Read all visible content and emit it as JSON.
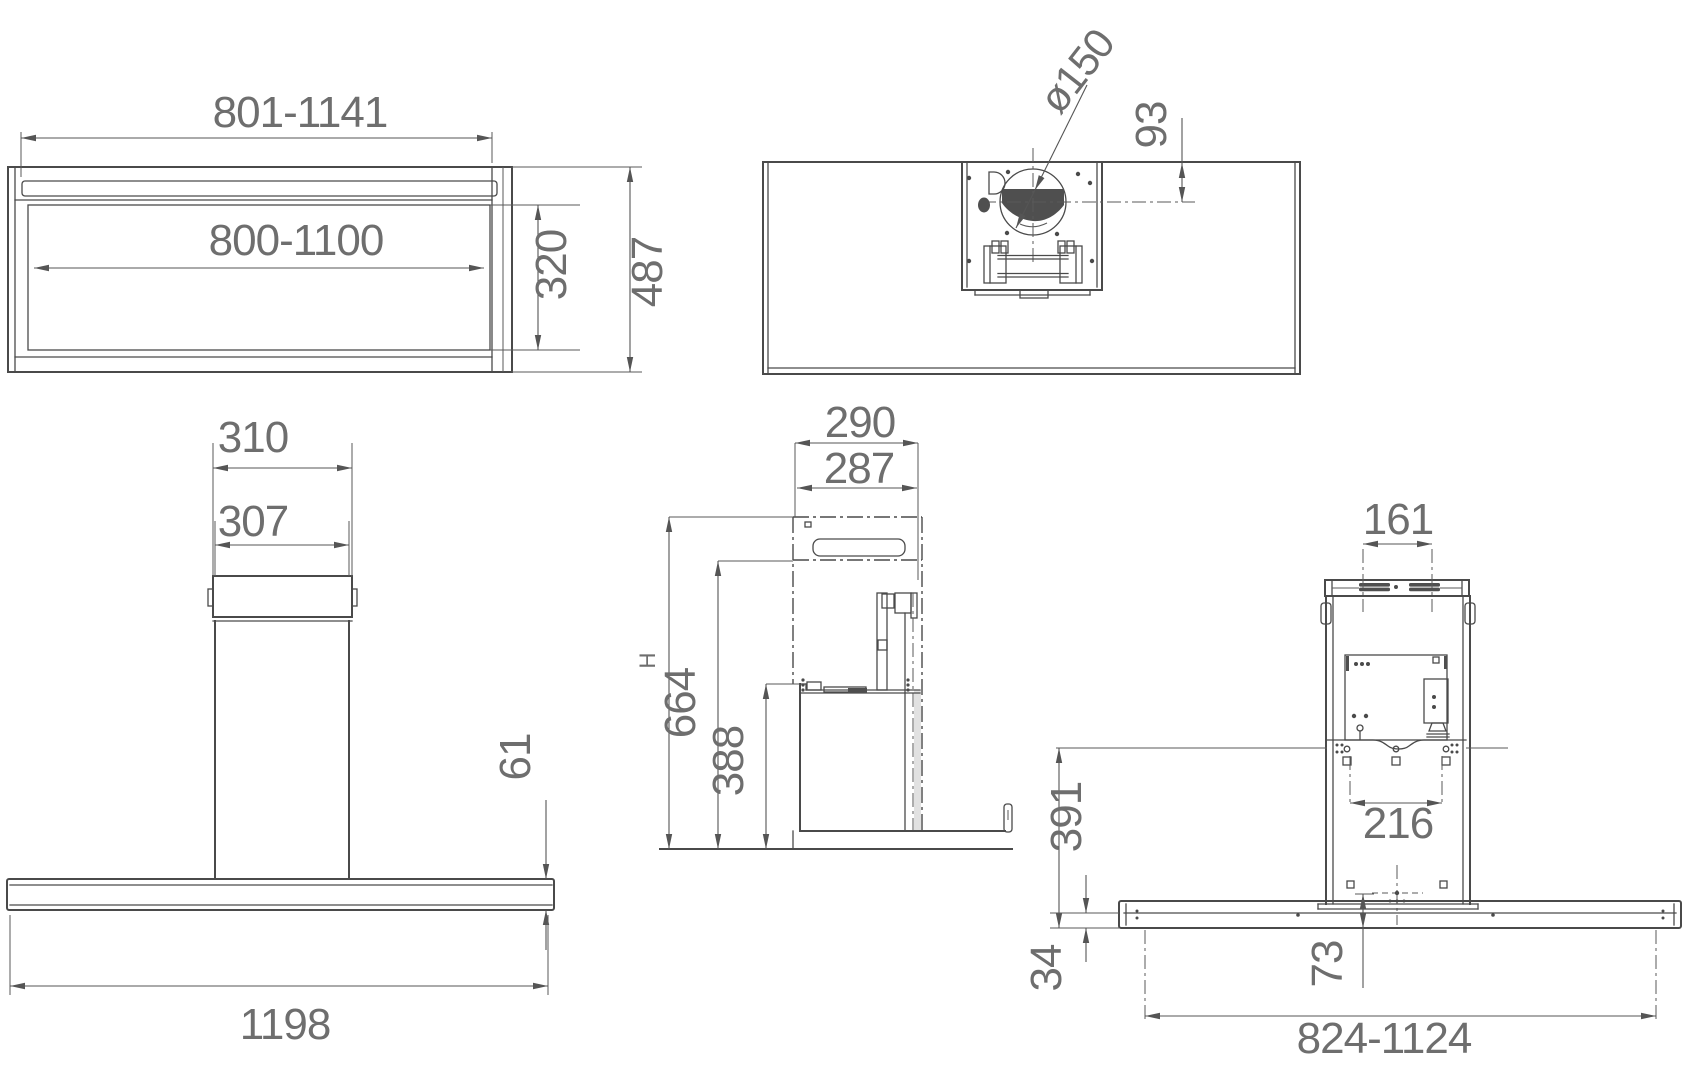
{
  "drawing": {
    "subject": "island-range-hood-installation-dimension-drawing",
    "units": "mm",
    "line_color": "#4a4a4a",
    "dim_color": "#555555",
    "text_color": "#6e6e6e",
    "dark_fill": "#4f4f4f",
    "background": "#ffffff"
  },
  "views": {
    "frontTop": {
      "name": "ceiling-frame front view",
      "widthOuter": "801-1141",
      "widthInner": "800-1100",
      "innerHeight": "320",
      "totalHeight": "487"
    },
    "plan": {
      "name": "top view",
      "ductDiameter": "ø150",
      "ductOffset": "93"
    },
    "front": {
      "name": "front view",
      "capOuterWidth": "310",
      "capInnerWidth": "307",
      "canopyThickness": "61",
      "canopyWidth": "1198"
    },
    "side": {
      "name": "side view",
      "depthOuter": "290",
      "depthInner": "287",
      "heightTotal": "H",
      "heightUpper": "664",
      "heightLower": "388"
    },
    "rear": {
      "name": "rear view",
      "ventSpacing": "161",
      "boltSpacing": "216",
      "backPanelHeight": "391",
      "canopyEdgeHeight": "34",
      "centerOffset": "73",
      "mountingSpan": "824-1124"
    }
  }
}
